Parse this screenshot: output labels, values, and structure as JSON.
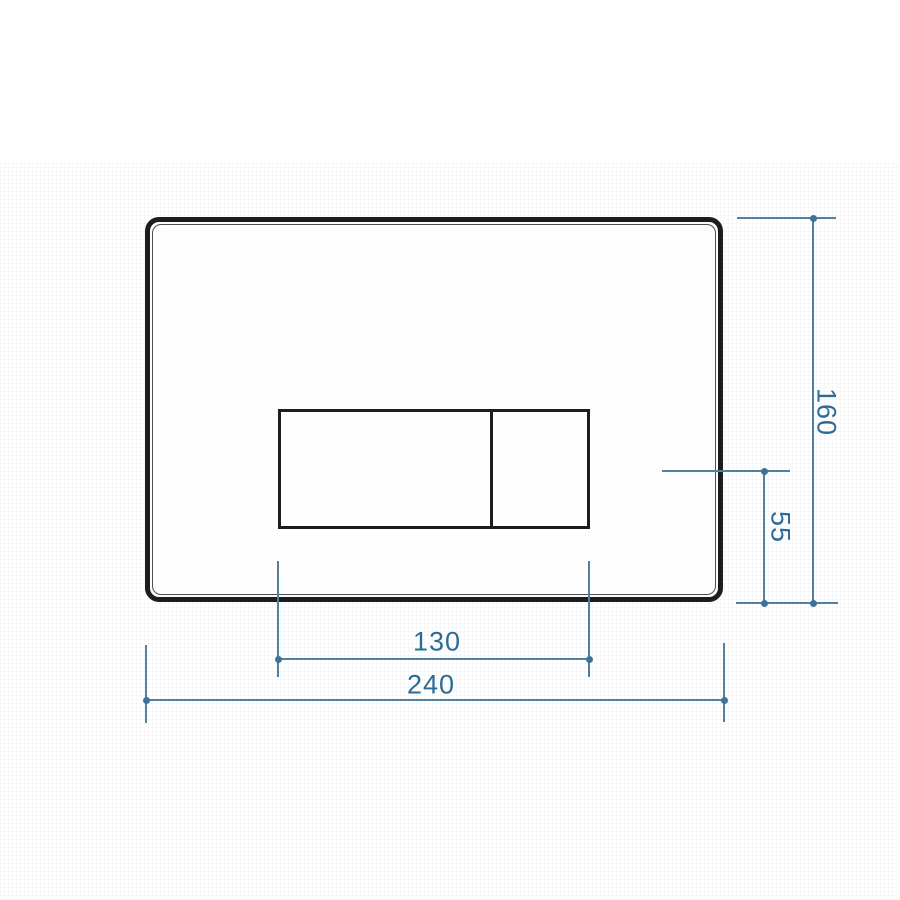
{
  "drawing": {
    "subject": "flush-plate-front-elevation-technical-drawing",
    "colors": {
      "plate_outline": "#1d1d1d",
      "plate_inner_line": "#505050",
      "dimension_line": "#53809f",
      "dimension_text": "#2b6b96",
      "background": "#ffffff"
    },
    "dimensions": {
      "plate_width": {
        "label": "240",
        "orientation": "horizontal"
      },
      "plate_height": {
        "label": "160",
        "orientation": "vertical"
      },
      "button_width": {
        "label": "130",
        "orientation": "horizontal"
      },
      "button_axis_from_bottom": {
        "label": "55",
        "orientation": "vertical"
      }
    }
  }
}
